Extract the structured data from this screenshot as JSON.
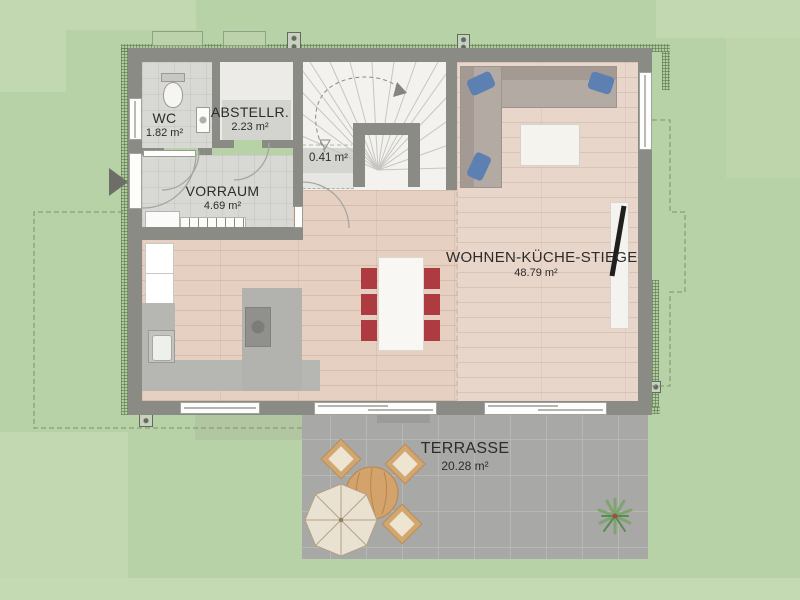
{
  "plan": {
    "title": "Erdgeschoss Grundriss",
    "rooms": [
      {
        "id": "wc",
        "name": "WC",
        "area": "1.82 m²"
      },
      {
        "id": "abstellraum",
        "name": "ABSTELLR.",
        "area": "2.23 m²"
      },
      {
        "id": "vorraum",
        "name": "VORRAUM",
        "area": "4.69 m²"
      },
      {
        "id": "stair-niche",
        "name": "",
        "area": "0.41 m²"
      },
      {
        "id": "wohnen-kueche-stiege",
        "name": "WOHNEN-KÜCHE-STIEGE",
        "area": "48.79 m²"
      },
      {
        "id": "terrasse",
        "name": "TERRASSE",
        "area": "20.28 m²"
      }
    ],
    "colors": {
      "grass": "#b7d2a6",
      "grass_light": "#c2d8b1",
      "wall": "#8b8b86",
      "wood_floor": "#e6d0c2",
      "living_floor": "#e9d6cb",
      "tile_floor": "#d8d8d4",
      "stair_floor": "#f3f2ee",
      "terrace": "#a8a8a6",
      "sofa": "#b2a9a3",
      "pillow_blue": "#5d80b2",
      "dining_chair_red": "#ae3b42",
      "outdoor_wood": "#d2a76f",
      "tv_black": "#1f1f1d"
    }
  }
}
